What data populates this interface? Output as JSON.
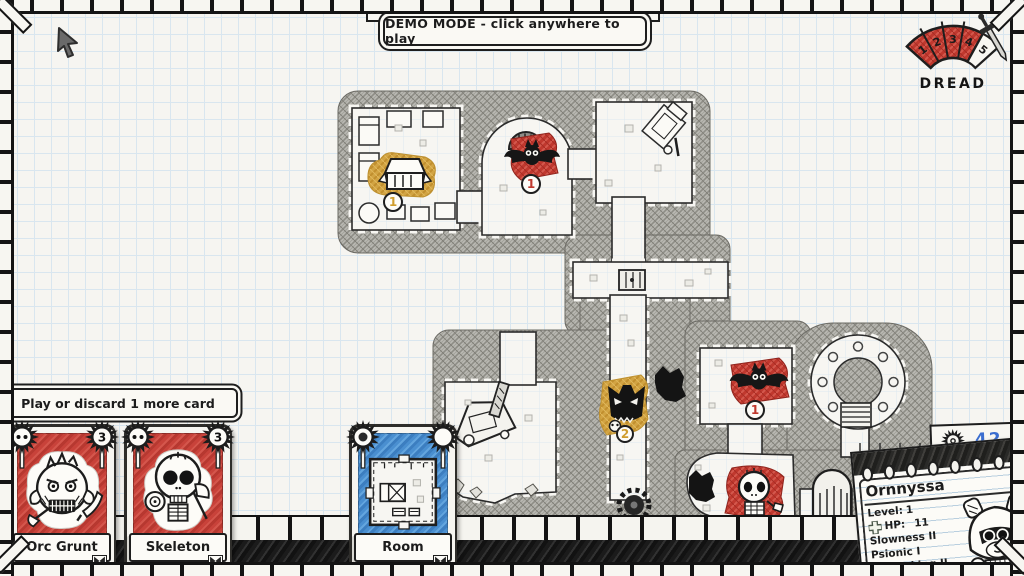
{
  "demo_banner": {
    "label": "DEMO MODE - click anywhere to play"
  },
  "dread": {
    "label": "DREAD",
    "ticks": [
      "1",
      "2",
      "3",
      "4",
      "5"
    ]
  },
  "prompt_banner": {
    "label": "Play or discard 1 more card"
  },
  "cards": {
    "orc": {
      "name": "Orc Grunt",
      "value": "3"
    },
    "skeleton": {
      "name": "Skeleton",
      "value": "3"
    },
    "room": {
      "name": "Room"
    }
  },
  "gold_counter": {
    "value": "42"
  },
  "character_sheet": {
    "name": "Ornnyssa",
    "level_label": "Level:",
    "level_value": "1",
    "hp_label": "HP:",
    "hp_value": "11",
    "traits": [
      "Slowness II",
      "Psionic I",
      "Berserking II"
    ]
  },
  "map": {
    "tokens": {
      "chest": "1",
      "bat_top": "1",
      "bat_right": "1",
      "mimic": "2"
    }
  },
  "colors": {
    "red": "#c0392e",
    "gold": "#cf9d2e",
    "blue": "#4a8fd0",
    "ink": "#1c1c1c",
    "blue_ink": "#3b6ed0"
  }
}
